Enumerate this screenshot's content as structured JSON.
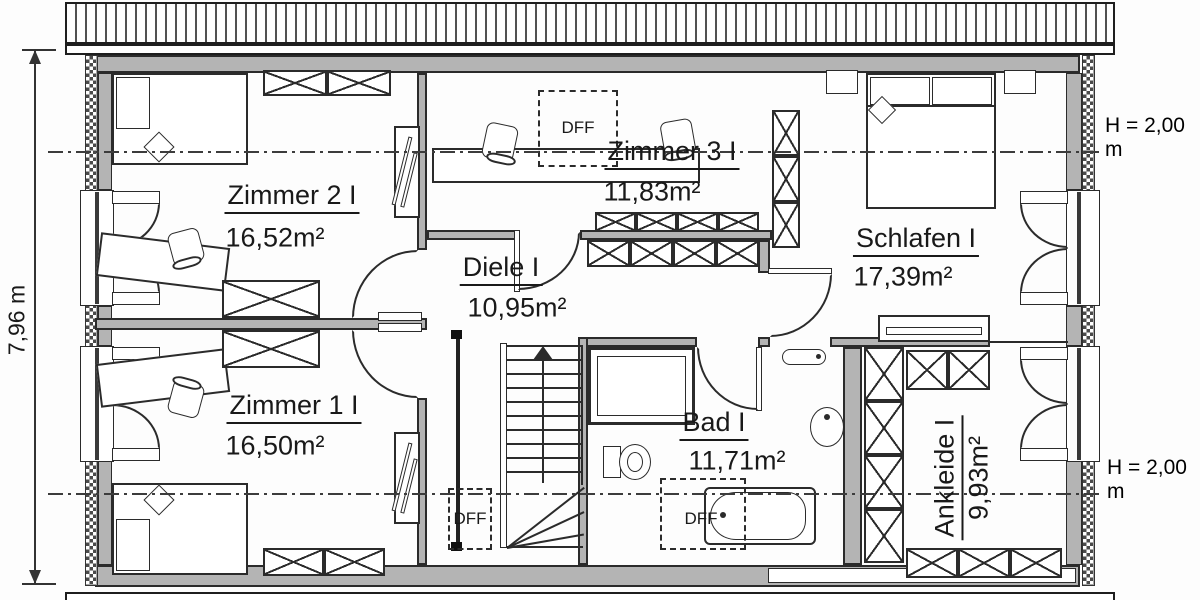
{
  "plan": {
    "rooms": [
      {
        "name": "Zimmer 2 I",
        "area": "16,52m²"
      },
      {
        "name": "Zimmer 3 I",
        "area": "11,83m²"
      },
      {
        "name": "Schlafen I",
        "area": "17,39m²"
      },
      {
        "name": "Diele I",
        "area": "10,95m²"
      },
      {
        "name": "Zimmer 1 I",
        "area": "16,50m²"
      },
      {
        "name": "Bad I",
        "area": "11,71m²"
      },
      {
        "name": "Ankleide I",
        "area": "9,93m²"
      }
    ],
    "skylights": {
      "label": "DFF"
    },
    "dimensions": {
      "overall_depth": "7,96 m",
      "knee_wall_height_top": "H = 2,00 m",
      "knee_wall_height_bottom": "H = 2,00 m"
    },
    "colors": {
      "wall": "#b4b4b4",
      "line": "#2b2b2b",
      "background": "#ffffff"
    }
  }
}
